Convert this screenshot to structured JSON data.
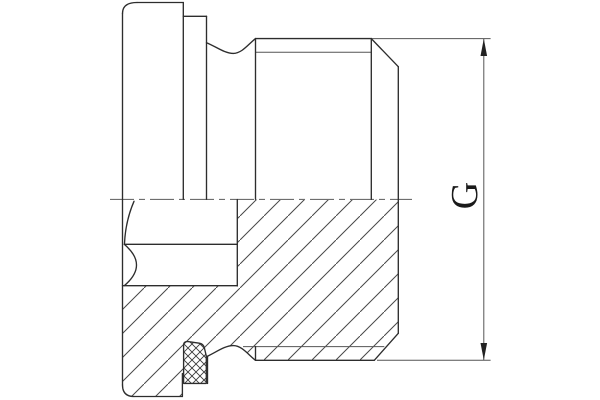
{
  "drawing": {
    "type": "technical-section-drawing",
    "subject": "threaded-screw-plug-with-seal-ring",
    "background": "#ffffff",
    "colors": {
      "outline": "#2d2d2d",
      "thin_line": "#555555",
      "hatch_line": "#484848",
      "seal_hatch_line": "#3a3a3a",
      "centerline": "#6e6e6e",
      "arrow": "#222222",
      "label": "#1a1a1a"
    },
    "hatch": {
      "angle_deg": 45,
      "steel_period_px": 24,
      "seal_cross_period_px": 8
    },
    "dimension": {
      "label": "G",
      "orientation": "rotated-90-ccw"
    },
    "centerline": {
      "d": "M110,199.4 L412,199.4"
    },
    "fills": [
      {
        "name": "steel-section-hatch",
        "layer": "fill-steel",
        "d": "M237.3,199.6 L398.3,199.6 L398.3,333.3 L374.3,360.3 L255.5,360.3 C248.5,355 242,345.6 233.3,345.6 C224.5,345.6 216,352.4 207.5,356.2 L206.3,356 L204.3,347.6 Q203.2,343.8 199.2,343.2 L188,341.6 Q183.6,341.2 183.6,345.2 L183.6,383.4 L182.4,383.4 L182.4,396.5 L134,396.5 Q122.5,396.5 122.5,385 L122.5,285.7 L237.3,285.7 Z"
      },
      {
        "name": "seal-ring-body",
        "layer": "fill-seal",
        "d": "M183.6,383.4 L183.6,345.2 Q183.6,341.2 188,341.6 L199.2,343.2 Q203.2,343.8 204.3,347.6 L206.3,356 L206.3,383.4 Z"
      },
      {
        "name": "seal-ring-crosshatch",
        "layer": "fill-seal-x",
        "d": "M183.6,383.4 L183.6,345.2 Q183.6,341.2 188,341.6 L199.2,343.2 Q203.2,343.8 204.3,347.6 L206.3,356 L206.3,383.4 Z"
      }
    ],
    "outlines": [
      {
        "name": "head-top-edge",
        "d": "M137,2.5 L183.3,2.5"
      },
      {
        "name": "head-top-corner",
        "d": "M122.5,13.5 Q122.5,2.5 137,2.5"
      },
      {
        "name": "head-left-face",
        "d": "M122.5,13.5 L122.5,385"
      },
      {
        "name": "head-bottom-corner",
        "d": "M122.5,385 Q122.5,396.5 134,396.5"
      },
      {
        "name": "head-bottom-edge",
        "d": "M134,396.5 L182.4,396.5"
      },
      {
        "name": "head-right-face-lower",
        "d": "M182.4,373.5 L182.4,396.5"
      },
      {
        "name": "head-face-rim-circle",
        "d": "M183.3,2.5 L183.3,199.3"
      },
      {
        "name": "seal-od-top",
        "d": "M183.3,16.3 L206.5,16.3"
      },
      {
        "name": "seal-face-rim-circle",
        "d": "M206.5,16.3 L206.5,199.3"
      },
      {
        "name": "neck-groove-top",
        "d": "M206.5,42.7 C216,46.5 224.5,53.4 233.3,53.4 C242,53.4 248.5,44 255.5,38.6"
      },
      {
        "name": "thread-start-circle",
        "d": "M255.5,38.6 L255.5,199.3"
      },
      {
        "name": "thread-crest-top",
        "d": "M255.5,38.6 L371.3,38.6"
      },
      {
        "name": "chamfer-start-circle",
        "d": "M371.3,38.6 L371.3,199.3"
      },
      {
        "name": "end-chamfer-top",
        "d": "M371.3,38.6 L398.3,66.7"
      },
      {
        "name": "end-face",
        "d": "M398.3,66.7 L398.3,333.3"
      },
      {
        "name": "end-chamfer-bottom",
        "d": "M398.3,333.3 L374.3,360.3"
      },
      {
        "name": "thread-crest-bottom",
        "d": "M374.3,360.3 L255.5,360.3"
      },
      {
        "name": "thread-runout-edge-bottom",
        "d": "M255.5,346.6 L255.5,360.3"
      },
      {
        "name": "neck-groove-bottom",
        "d": "M207.5,356.2 C216,352.4 224.5,345.6 233.3,345.6 C242,345.6 248.5,355 255.5,360.3"
      },
      {
        "name": "groove-wall-bottom",
        "d": "M207.5,356.2 L207.5,383.5"
      },
      {
        "name": "socket-bottom-circle",
        "d": "M237.3,199.5 L237.3,286"
      },
      {
        "name": "socket-flat-line",
        "d": "M124.3,244.3 L237.3,244.3"
      },
      {
        "name": "socket-corner-line",
        "d": "M122.5,285.7 L237.3,285.7"
      },
      {
        "name": "socket-countersink-arc",
        "d": "M134,201.3 Q125.5,221 124.5,243.5"
      },
      {
        "name": "socket-corner-arc",
        "d": "M124.5,244.5 Q148.5,265 124.5,285.5"
      },
      {
        "name": "seal-outline",
        "d": "M183.6,383.4 L183.6,345.2 Q183.6,341.2 188,341.6 L199.2,343.2 Q203.2,343.8 204.3,347.6 L206.3,356 L206.3,383.4 Z"
      }
    ],
    "thin_lines": [
      {
        "name": "thread-root-top",
        "d": "M255.5,52.3 L371.3,52.3"
      },
      {
        "name": "thread-root-bottom",
        "d": "M243,346.6 L384.3,346.6"
      },
      {
        "name": "extension-line-top",
        "d": "M371.3,38.6 L490.6,38.6"
      },
      {
        "name": "extension-line-bottom",
        "d": "M377,360.3 L490.6,360.3"
      },
      {
        "name": "dimension-line",
        "d": "M483.8,39 L483.8,360"
      }
    ],
    "arrows": [
      {
        "name": "dimension-arrow-up",
        "d": "M483.8,38.8 L480.5,56 L487.1,56 Z"
      },
      {
        "name": "dimension-arrow-down",
        "d": "M483.8,360.1 L480.5,343 L487.1,343 Z"
      }
    ]
  }
}
